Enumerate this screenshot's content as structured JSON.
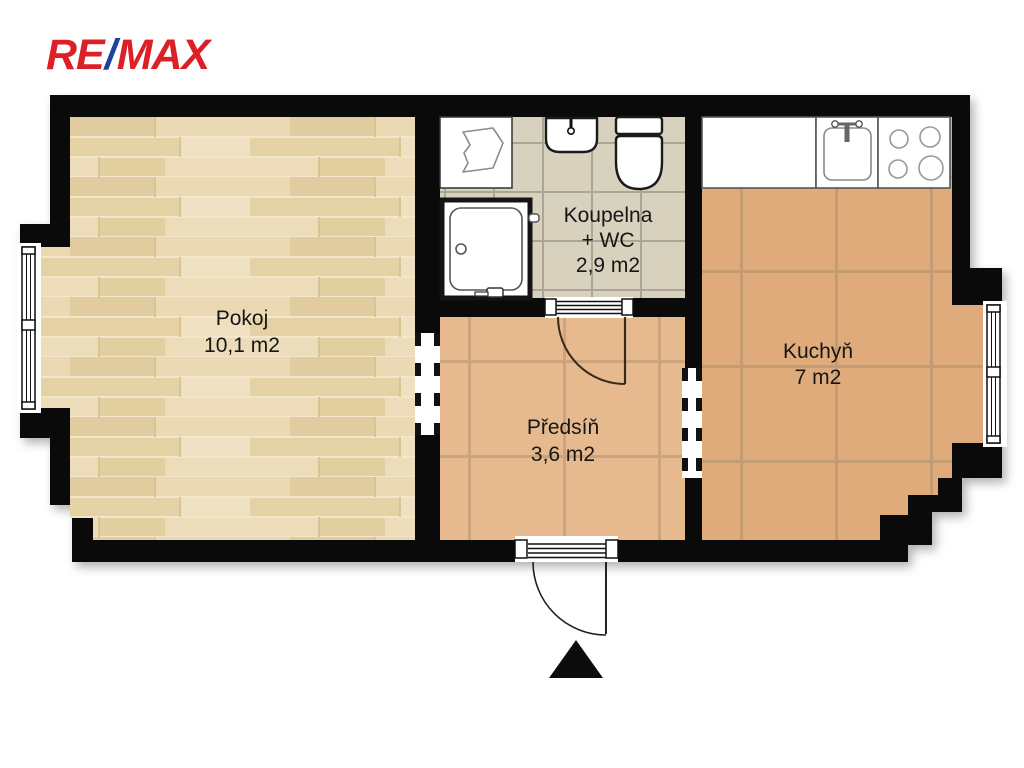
{
  "brand": {
    "re": "RE",
    "slash": "/",
    "max": "MAX",
    "red": "#dd1f26",
    "blue": "#2240a0"
  },
  "plan": {
    "wall_color": "#0a0a0a",
    "rooms": [
      {
        "key": "pokoj",
        "name": "Pokoj",
        "area": "10,1 m2",
        "floor": "wood-planks",
        "floor_color": "#e8d8b0"
      },
      {
        "key": "koupelna",
        "name": "Koupelna",
        "sub": "+ WC",
        "area": "2,9 m2",
        "floor": "ceramic-tile",
        "floor_color": "#d8d1bd"
      },
      {
        "key": "predsin",
        "name": "Předsíň",
        "area": "3,6 m2",
        "floor": "terracotta-tile",
        "floor_color": "#e6ba8e"
      },
      {
        "key": "kuchyn",
        "name": "Kuchyň",
        "area": "7 m2",
        "floor": "terracotta-tile",
        "floor_color": "#dfab7b"
      }
    ],
    "fixtures": [
      "washing-machine",
      "shower",
      "bathroom-sink",
      "toilet",
      "kitchen-counter",
      "kitchen-sink",
      "stove-4-burners"
    ],
    "windows": [
      "left-window-pokoj",
      "right-window-kuchyn"
    ],
    "doors": [
      "entrance-door-bottom",
      "bathroom-door"
    ],
    "openings": [
      "pokoj-predsin",
      "predsin-kuchyn"
    ],
    "north_arrow": "black-triangle-up"
  }
}
